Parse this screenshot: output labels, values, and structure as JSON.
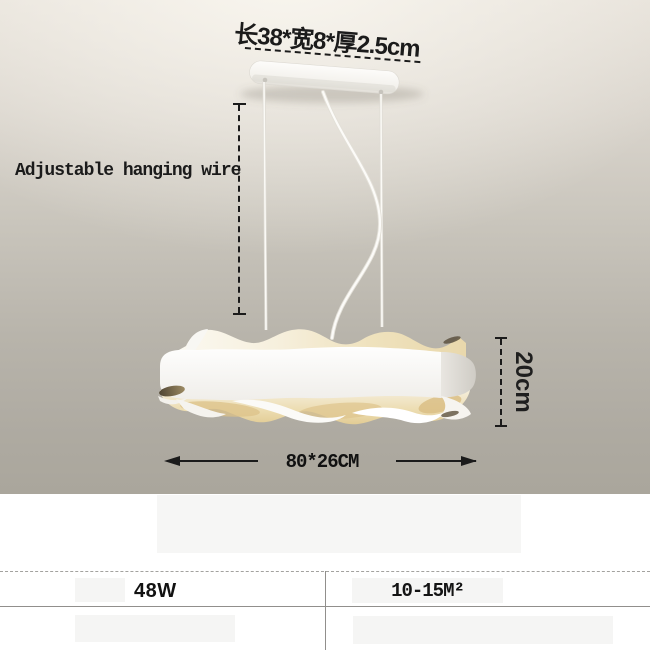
{
  "annotations": {
    "canopy_size": "长38*宽8*厚2.5cm",
    "hanging_wire": "Adjustable hanging wire",
    "shade_height": "20cm",
    "shade_size": "80*26CM"
  },
  "specs": {
    "power": "48W",
    "coverage_area": "10-15M²"
  },
  "colors": {
    "wall_top": "#f2eee7",
    "wall_bottom": "#aaa69c",
    "lamp_white": "#fbfaf8",
    "lamp_glow": "#ead9ad",
    "curl_shadow": "#5f5340",
    "panel_background": "#ffffff",
    "placeholder_box": "#f5f5f4",
    "annotation_ink": "#1b1b1b"
  }
}
